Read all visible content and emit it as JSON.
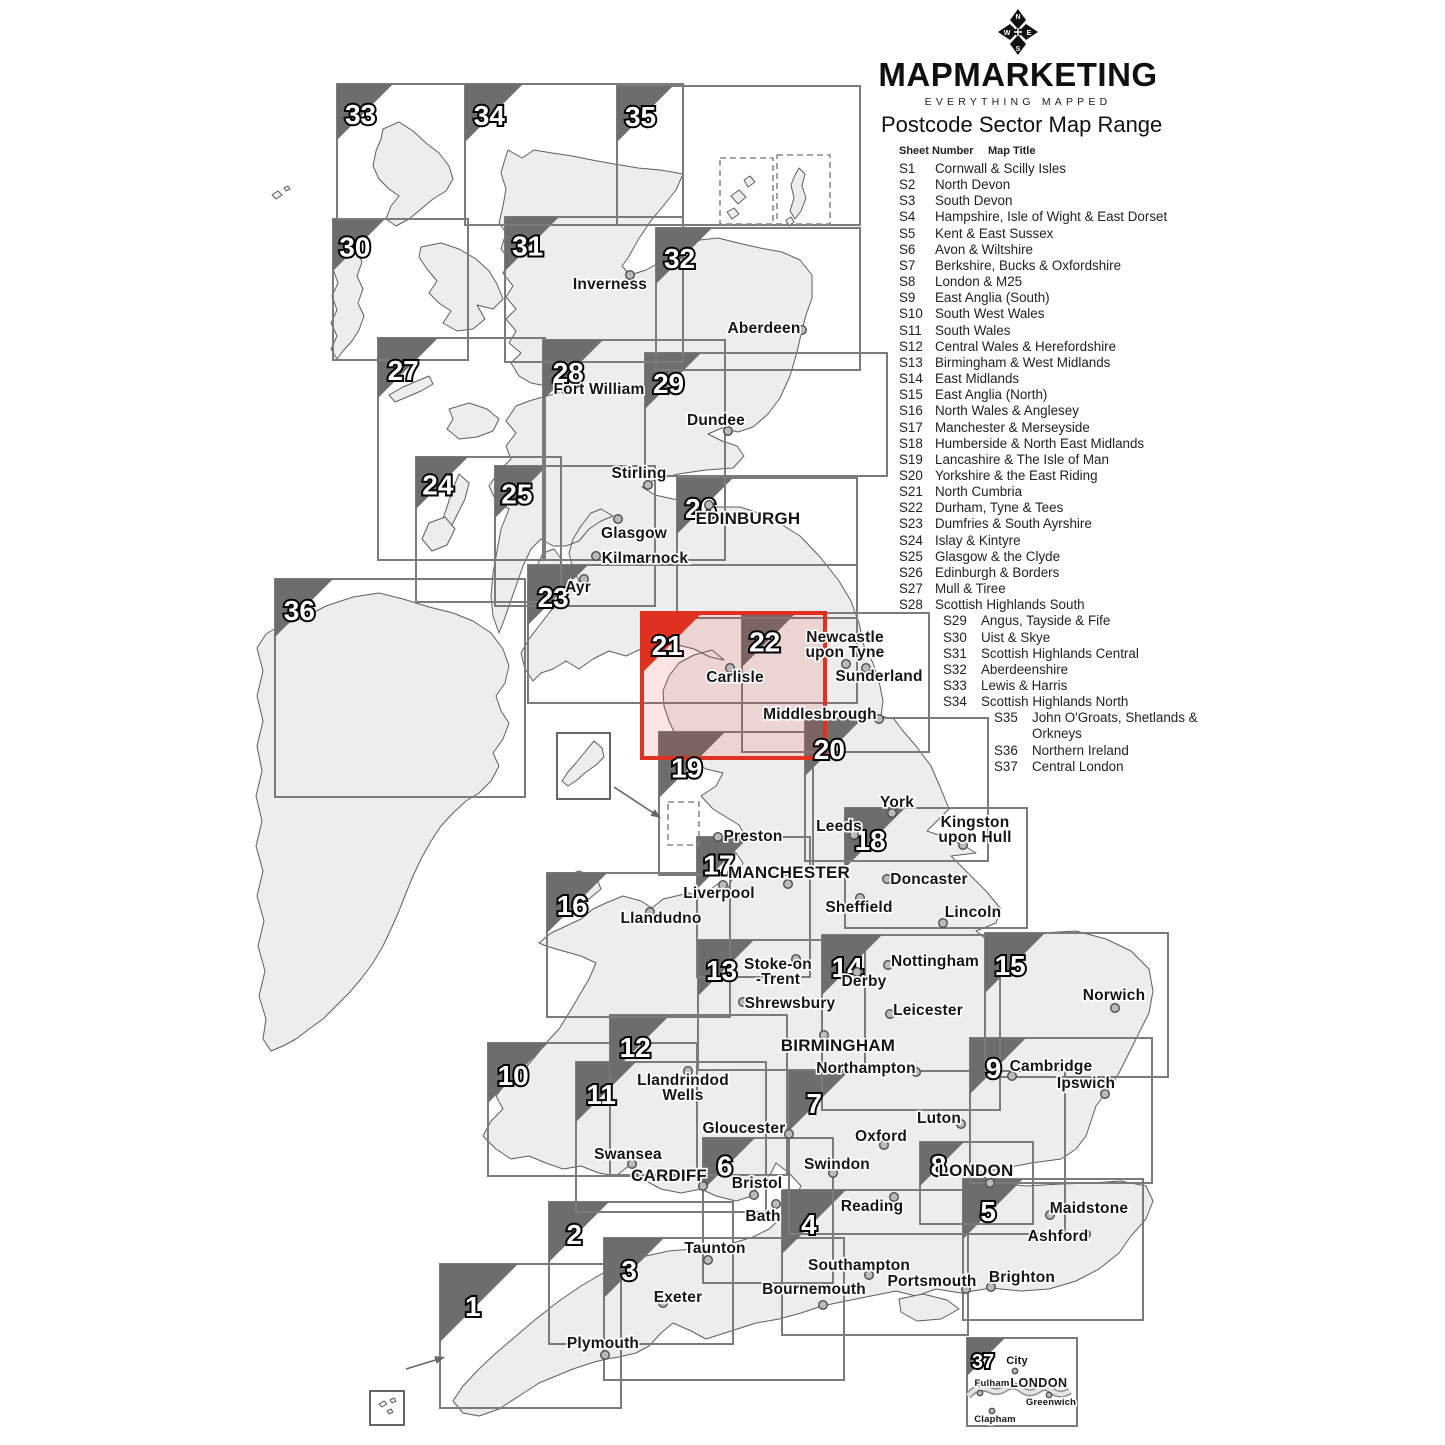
{
  "brand": {
    "name": "MAPMARKETING",
    "tagline": "EVERYTHING MAPPED",
    "compass_letters": [
      "N",
      "E",
      "S",
      "W"
    ]
  },
  "header": {
    "title": "Postcode Sector Map Range"
  },
  "legend": {
    "col1": "Sheet Number",
    "col2": "Map Title",
    "items": [
      {
        "sheet": "S1",
        "title": "Cornwall & Scilly Isles",
        "indent": 0
      },
      {
        "sheet": "S2",
        "title": "North Devon",
        "indent": 0
      },
      {
        "sheet": "S3",
        "title": "South Devon",
        "indent": 0
      },
      {
        "sheet": "S4",
        "title": "Hampshire, Isle of Wight & East Dorset",
        "indent": 0
      },
      {
        "sheet": "S5",
        "title": "Kent & East Sussex",
        "indent": 0
      },
      {
        "sheet": "S6",
        "title": "Avon & Wiltshire",
        "indent": 0
      },
      {
        "sheet": "S7",
        "title": "Berkshire, Bucks & Oxfordshire",
        "indent": 0
      },
      {
        "sheet": "S8",
        "title": "London & M25",
        "indent": 0
      },
      {
        "sheet": "S9",
        "title": "East Anglia (South)",
        "indent": 0
      },
      {
        "sheet": "S10",
        "title": "South West Wales",
        "indent": 0
      },
      {
        "sheet": "S11",
        "title": "South Wales",
        "indent": 0
      },
      {
        "sheet": "S12",
        "title": "Central Wales & Herefordshire",
        "indent": 0
      },
      {
        "sheet": "S13",
        "title": "Birmingham & West Midlands",
        "indent": 0
      },
      {
        "sheet": "S14",
        "title": "East Midlands",
        "indent": 0
      },
      {
        "sheet": "S15",
        "title": "East Anglia (North)",
        "indent": 0
      },
      {
        "sheet": "S16",
        "title": "North Wales & Anglesey",
        "indent": 0
      },
      {
        "sheet": "S17",
        "title": "Manchester & Merseyside",
        "indent": 0
      },
      {
        "sheet": "S18",
        "title": "Humberside & North East Midlands",
        "indent": 0
      },
      {
        "sheet": "S19",
        "title": "Lancashire & The Isle of Man",
        "indent": 0
      },
      {
        "sheet": "S20",
        "title": "Yorkshire & the East Riding",
        "indent": 0
      },
      {
        "sheet": "S21",
        "title": "North Cumbria",
        "indent": 0
      },
      {
        "sheet": "S22",
        "title": "Durham, Tyne & Tees",
        "indent": 0
      },
      {
        "sheet": "S23",
        "title": "Dumfries & South Ayrshire",
        "indent": 0
      },
      {
        "sheet": "S24",
        "title": "Islay & Kintyre",
        "indent": 0
      },
      {
        "sheet": "S25",
        "title": "Glasgow & the Clyde",
        "indent": 0
      },
      {
        "sheet": "S26",
        "title": "Edinburgh & Borders",
        "indent": 0
      },
      {
        "sheet": "S27",
        "title": "Mull & Tiree",
        "indent": 0
      },
      {
        "sheet": "S28",
        "title": "Scottish Highlands South",
        "indent": 0
      },
      {
        "sheet": "S29",
        "title": "Angus, Tayside & Fife",
        "indent": 1
      },
      {
        "sheet": "S30",
        "title": "Uist & Skye",
        "indent": 1
      },
      {
        "sheet": "S31",
        "title": "Scottish Highlands Central",
        "indent": 1
      },
      {
        "sheet": "S32",
        "title": "Aberdeenshire",
        "indent": 1
      },
      {
        "sheet": "S33",
        "title": "Lewis & Harris",
        "indent": 1
      },
      {
        "sheet": "S34",
        "title": "Scottish Highlands North",
        "indent": 1
      },
      {
        "sheet": "S35",
        "title": "John O'Groats, Shetlands & Orkneys",
        "indent": 2
      },
      {
        "sheet": "S36",
        "title": "Northern Ireland",
        "indent": 2
      },
      {
        "sheet": "S37",
        "title": "Central London",
        "indent": 2
      }
    ]
  },
  "colors": {
    "box_border": "#7b7b7b",
    "triangle": "#6d6d6d",
    "highlight_red": "#e0301f",
    "highlight_fill": "rgba(224,48,31,0.13)",
    "land": "#ededed",
    "coast": "#5e5e5e",
    "dot_fill": "#bbbbbb",
    "dot_stroke": "#4d4d4d"
  },
  "map": {
    "highlighted_sheet": 21,
    "sheets": [
      {
        "n": 1,
        "x": 440,
        "y": 1264,
        "w": 181,
        "h": 144,
        "t": 78
      },
      {
        "n": 2,
        "x": 549,
        "y": 1202,
        "w": 184,
        "h": 142,
        "t": 60
      },
      {
        "n": 3,
        "x": 604,
        "y": 1238,
        "w": 240,
        "h": 142,
        "t": 60
      },
      {
        "n": 4,
        "x": 782,
        "y": 1190,
        "w": 186,
        "h": 145,
        "t": 64
      },
      {
        "n": 5,
        "x": 963,
        "y": 1179,
        "w": 180,
        "h": 141,
        "t": 60
      },
      {
        "n": 6,
        "x": 703,
        "y": 1138,
        "w": 130,
        "h": 145,
        "t": 52
      },
      {
        "n": 7,
        "x": 789,
        "y": 1071,
        "w": 276,
        "h": 163,
        "t": 60
      },
      {
        "n": 8,
        "x": 920,
        "y": 1142,
        "w": 113,
        "h": 82,
        "t": 44
      },
      {
        "n": 9,
        "x": 970,
        "y": 1038,
        "w": 182,
        "h": 145,
        "t": 56
      },
      {
        "n": 10,
        "x": 488,
        "y": 1043,
        "w": 209,
        "h": 133,
        "t": 60
      },
      {
        "n": 11,
        "x": 576,
        "y": 1062,
        "w": 190,
        "h": 150,
        "t": 60
      },
      {
        "n": 12,
        "x": 610,
        "y": 1015,
        "w": 177,
        "h": 160,
        "t": 60
      },
      {
        "n": 13,
        "x": 698,
        "y": 940,
        "w": 167,
        "h": 130,
        "t": 56
      },
      {
        "n": 14,
        "x": 822,
        "y": 935,
        "w": 178,
        "h": 175,
        "t": 60
      },
      {
        "n": 15,
        "x": 985,
        "y": 933,
        "w": 183,
        "h": 144,
        "t": 60
      },
      {
        "n": 16,
        "x": 547,
        "y": 873,
        "w": 183,
        "h": 144,
        "t": 60
      },
      {
        "n": 17,
        "x": 697,
        "y": 837,
        "w": 113,
        "h": 140,
        "t": 52
      },
      {
        "n": 18,
        "x": 845,
        "y": 808,
        "w": 182,
        "h": 120,
        "t": 60
      },
      {
        "n": 19,
        "x": 659,
        "y": 732,
        "w": 154,
        "h": 143,
        "t": 66
      },
      {
        "n": 20,
        "x": 805,
        "y": 718,
        "w": 183,
        "h": 143,
        "t": 58
      },
      {
        "n": 21,
        "x": 642,
        "y": 613,
        "w": 183,
        "h": 145,
        "t": 60,
        "highlight": true
      },
      {
        "n": 22,
        "x": 742,
        "y": 613,
        "w": 187,
        "h": 139,
        "t": 54
      },
      {
        "n": 23,
        "x": 528,
        "y": 565,
        "w": 329,
        "h": 138,
        "t": 60
      },
      {
        "n": 24,
        "x": 416,
        "y": 457,
        "w": 145,
        "h": 145,
        "t": 52
      },
      {
        "n": 25,
        "x": 495,
        "y": 466,
        "w": 160,
        "h": 140,
        "t": 52
      },
      {
        "n": 26,
        "x": 677,
        "y": 478,
        "w": 180,
        "h": 140,
        "t": 56
      },
      {
        "n": 27,
        "x": 378,
        "y": 338,
        "w": 167,
        "h": 222,
        "t": 60
      },
      {
        "n": 28,
        "x": 543,
        "y": 340,
        "w": 182,
        "h": 220,
        "t": 60
      },
      {
        "n": 29,
        "x": 645,
        "y": 353,
        "w": 242,
        "h": 123,
        "t": 56
      },
      {
        "n": 30,
        "x": 333,
        "y": 219,
        "w": 135,
        "h": 141,
        "t": 52
      },
      {
        "n": 31,
        "x": 505,
        "y": 217,
        "w": 178,
        "h": 145,
        "t": 54
      },
      {
        "n": 32,
        "x": 656,
        "y": 228,
        "w": 204,
        "h": 142,
        "t": 56
      },
      {
        "n": 33,
        "x": 337,
        "y": 84,
        "w": 128,
        "h": 135,
        "t": 56
      },
      {
        "n": 34,
        "x": 465,
        "y": 84,
        "w": 218,
        "h": 141,
        "t": 58
      },
      {
        "n": 35,
        "x": 617,
        "y": 86,
        "w": 243,
        "h": 139,
        "t": 56
      },
      {
        "n": 36,
        "x": 275,
        "y": 579,
        "w": 250,
        "h": 218,
        "t": 58
      },
      {
        "n": 37,
        "x": 967,
        "y": 1338,
        "w": 110,
        "h": 88,
        "t": 38,
        "ns": 20
      }
    ],
    "cities": [
      {
        "t": [
          "Inverness"
        ],
        "x": 610,
        "y": 289,
        "dot": [
          630,
          275
        ]
      },
      {
        "t": [
          "Aberdeen"
        ],
        "x": 764,
        "y": 333,
        "dot": [
          802,
          330
        ]
      },
      {
        "t": [
          "Fort William"
        ],
        "x": 599,
        "y": 394,
        "dot": [
          566,
          390
        ]
      },
      {
        "t": [
          "Dundee"
        ],
        "x": 716,
        "y": 425,
        "dot": [
          728,
          431
        ]
      },
      {
        "t": [
          "Stirling"
        ],
        "x": 639,
        "y": 478,
        "dot": [
          648,
          485
        ]
      },
      {
        "t": [
          "Glasgow"
        ],
        "x": 634,
        "y": 538,
        "dot": [
          618,
          519
        ]
      },
      {
        "t": [
          "Kilmarnock"
        ],
        "x": 645,
        "y": 563,
        "dot": [
          596,
          556
        ]
      },
      {
        "t": [
          "EDINBURGH"
        ],
        "x": 748,
        "y": 524,
        "dot": [
          709,
          505
        ],
        "cls": "caps"
      },
      {
        "t": [
          "Ayr"
        ],
        "x": 578,
        "y": 592,
        "dot": [
          584,
          579
        ]
      },
      {
        "t": [
          "Newcastle",
          "upon Tyne"
        ],
        "x": 845,
        "y": 642,
        "dot": [
          846,
          664
        ]
      },
      {
        "t": [
          "Sunderland"
        ],
        "x": 879,
        "y": 681,
        "dot": [
          866,
          668
        ]
      },
      {
        "t": [
          "Carlisle"
        ],
        "x": 735,
        "y": 682,
        "dot": [
          730,
          668
        ]
      },
      {
        "t": [
          "Middlesbrough"
        ],
        "x": 820,
        "y": 719,
        "dot": [
          879,
          719
        ]
      },
      {
        "t": [
          "York"
        ],
        "x": 897,
        "y": 807,
        "dot": [
          892,
          813
        ]
      },
      {
        "t": [
          "Leeds"
        ],
        "x": 839,
        "y": 831,
        "dot": [
          854,
          835
        ]
      },
      {
        "t": [
          "Kingston",
          "upon Hull"
        ],
        "x": 975,
        "y": 827,
        "dot": [
          963,
          845
        ]
      },
      {
        "t": [
          "Preston"
        ],
        "x": 753,
        "y": 841,
        "dot": [
          718,
          837
        ]
      },
      {
        "t": [
          "MANCHESTER"
        ],
        "x": 789,
        "y": 878,
        "dot": [
          788,
          884
        ],
        "cls": "caps"
      },
      {
        "t": [
          "Liverpool"
        ],
        "x": 719,
        "y": 898,
        "dot": [
          723,
          885
        ]
      },
      {
        "t": [
          "Doncaster"
        ],
        "x": 929,
        "y": 884,
        "dot": [
          887,
          879
        ]
      },
      {
        "t": [
          "Sheffield"
        ],
        "x": 859,
        "y": 912,
        "dot": [
          860,
          898
        ]
      },
      {
        "t": [
          "Lincoln"
        ],
        "x": 973,
        "y": 917,
        "dot": [
          943,
          923
        ]
      },
      {
        "t": [
          "Llandudno"
        ],
        "x": 661,
        "y": 923,
        "dot": [
          650,
          912
        ]
      },
      {
        "t": [
          "Stoke-on",
          "-Trent"
        ],
        "x": 778,
        "y": 969,
        "dot": [
          796,
          959
        ]
      },
      {
        "t": [
          "Shrewsbury"
        ],
        "x": 790,
        "y": 1008,
        "dot": [
          743,
          1002
        ]
      },
      {
        "t": [
          "Nottingham"
        ],
        "x": 935,
        "y": 966,
        "dot": [
          888,
          965
        ]
      },
      {
        "t": [
          "Derby"
        ],
        "x": 864,
        "y": 986,
        "dot": [
          857,
          972
        ]
      },
      {
        "t": [
          "Leicester"
        ],
        "x": 928,
        "y": 1015,
        "dot": [
          890,
          1014
        ]
      },
      {
        "t": [
          "BIRMINGHAM"
        ],
        "x": 838,
        "y": 1051,
        "dot": [
          824,
          1035
        ],
        "cls": "caps"
      },
      {
        "t": [
          "Northampton"
        ],
        "x": 866,
        "y": 1073,
        "dot": [
          916,
          1072
        ]
      },
      {
        "t": [
          "Llandrindod",
          "Wells"
        ],
        "x": 683,
        "y": 1085,
        "dot": [
          688,
          1071
        ]
      },
      {
        "t": [
          "Gloucester"
        ],
        "x": 744,
        "y": 1133,
        "dot": [
          789,
          1134
        ]
      },
      {
        "t": [
          "Swansea"
        ],
        "x": 628,
        "y": 1159,
        "dot": [
          632,
          1164
        ]
      },
      {
        "t": [
          "CARDIFF"
        ],
        "x": 669,
        "y": 1181,
        "dot": [
          703,
          1186
        ],
        "cls": "caps"
      },
      {
        "t": [
          "Bristol"
        ],
        "x": 757,
        "y": 1188,
        "dot": [
          754,
          1195
        ]
      },
      {
        "t": [
          "Bath"
        ],
        "x": 763,
        "y": 1221,
        "dot": [
          776,
          1204
        ]
      },
      {
        "t": [
          "Swindon"
        ],
        "x": 837,
        "y": 1169,
        "dot": [
          833,
          1173
        ]
      },
      {
        "t": [
          "Oxford"
        ],
        "x": 881,
        "y": 1141,
        "dot": [
          884,
          1145
        ]
      },
      {
        "t": [
          "Luton"
        ],
        "x": 939,
        "y": 1123,
        "dot": [
          961,
          1124
        ]
      },
      {
        "t": [
          "Reading"
        ],
        "x": 872,
        "y": 1211,
        "dot": [
          894,
          1197
        ]
      },
      {
        "t": [
          "LONDON"
        ],
        "x": 976,
        "y": 1176,
        "dot": [
          990,
          1183
        ],
        "cls": "caps"
      },
      {
        "t": [
          "Maidstone"
        ],
        "x": 1089,
        "y": 1213,
        "dot": [
          1050,
          1215
        ]
      },
      {
        "t": [
          "Ashford"
        ],
        "x": 1058,
        "y": 1241,
        "dot": [
          1086,
          1234
        ]
      },
      {
        "t": [
          "Brighton"
        ],
        "x": 1022,
        "y": 1282,
        "dot": [
          991,
          1287
        ]
      },
      {
        "t": [
          "Portsmouth"
        ],
        "x": 932,
        "y": 1286,
        "dot": [
          966,
          1289
        ]
      },
      {
        "t": [
          "Southampton"
        ],
        "x": 859,
        "y": 1270,
        "dot": [
          869,
          1275
        ]
      },
      {
        "t": [
          "Bournemouth"
        ],
        "x": 814,
        "y": 1294,
        "dot": [
          823,
          1305
        ]
      },
      {
        "t": [
          "Taunton"
        ],
        "x": 715,
        "y": 1253,
        "dot": [
          708,
          1260
        ]
      },
      {
        "t": [
          "Exeter"
        ],
        "x": 678,
        "y": 1302,
        "dot": [
          663,
          1303
        ]
      },
      {
        "t": [
          "Plymouth"
        ],
        "x": 603,
        "y": 1348,
        "dot": [
          605,
          1355
        ]
      },
      {
        "t": [
          "Norwich"
        ],
        "x": 1114,
        "y": 1000,
        "dot": [
          1115,
          1008
        ]
      },
      {
        "t": [
          "Cambridge"
        ],
        "x": 1051,
        "y": 1071,
        "dot": [
          1012,
          1076
        ]
      },
      {
        "t": [
          "Ipswich"
        ],
        "x": 1086,
        "y": 1088,
        "dot": [
          1105,
          1094
        ]
      }
    ],
    "london_inset_labels": [
      {
        "t": [
          "City"
        ],
        "x": 1017,
        "y": 1364,
        "dot": [
          1015,
          1371
        ],
        "cls": "ins-b"
      },
      {
        "t": [
          "LONDON"
        ],
        "x": 1039,
        "y": 1387,
        "cls": "ins-c"
      },
      {
        "t": [
          "Fulham"
        ],
        "x": 992,
        "y": 1386,
        "dot": [
          980,
          1393
        ],
        "cls": "ins-s"
      },
      {
        "t": [
          "Greenwich"
        ],
        "x": 1051,
        "y": 1405,
        "dot": [
          1049,
          1395
        ],
        "cls": "ins-s"
      },
      {
        "t": [
          "Clapham"
        ],
        "x": 995,
        "y": 1422,
        "dot": [
          992,
          1411
        ],
        "cls": "ins-s"
      }
    ]
  }
}
